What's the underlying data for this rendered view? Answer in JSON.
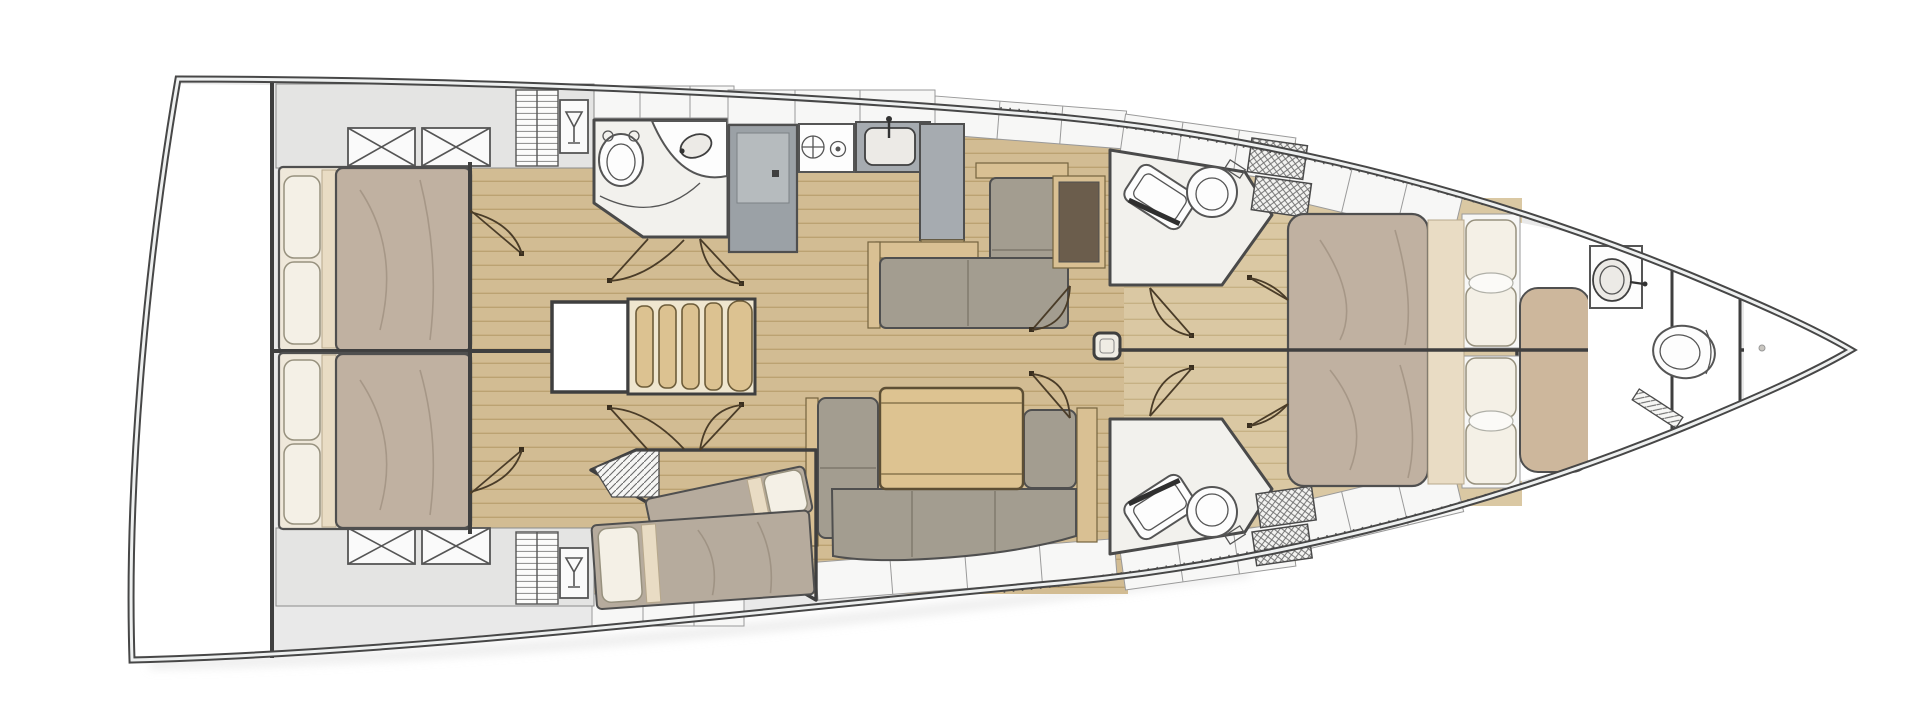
{
  "plan": {
    "label": "Sailing yacht interior layout floor plan, bow pointing right",
    "orientation": "bow-right",
    "visible_text": ""
  },
  "palette": {
    "wall": "#3f3f3f",
    "deck": "#e9e9e9",
    "hull-rail": "#474747",
    "hull-gap": "#eef0f0",
    "panel": "#f7f7f6",
    "head-floor": "#f2f1ed",
    "floor-wood": "#d2bc93",
    "floor-wood-line": "#bba272",
    "floor-fwd": "#dac8a3",
    "floor-fwd-line": "#c6b184",
    "cabinet-gray": "#9ba1a6",
    "cabinet-gray-light": "#b6bbbe",
    "counter-gray": "#a6abb0",
    "sofa": "#a39d90",
    "sofa-line": "#7e786c",
    "wood-trim": "#d9c093",
    "wood-trim-line": "#74643f",
    "table": "#ddc391",
    "bed-blanket": "#c0b1a1",
    "bed-blanket-gray": "#b6ab9d",
    "bed-sheet": "#e9dcc4",
    "pillow": "#f4f0e6",
    "pillow-line": "#97917e",
    "dark-top": "#6b5d4c",
    "stair": "#dcc291",
    "bench-tan": "#cdb79c",
    "door": "#4a3c28",
    "fixture-line": "#555555"
  },
  "rooms": [
    {
      "id": "stern-platform",
      "label": "Stern / transom platform",
      "fixtures": []
    },
    {
      "id": "aft-cabin-port",
      "label": "Aft cabin port (top)",
      "fixtures": [
        "double-bed",
        "pillows",
        "wardrobe-x-doors",
        "shelf-locker",
        "hanging-locker"
      ]
    },
    {
      "id": "aft-cabin-starboard",
      "label": "Aft cabin starboard (bottom)",
      "fixtures": [
        "double-bed",
        "pillows",
        "wardrobe-x-doors",
        "shelf-locker",
        "hanging-locker"
      ]
    },
    {
      "id": "companionway",
      "label": "Companionway stairs and landing",
      "fixtures": [
        "stairs",
        "landing-hatch"
      ]
    },
    {
      "id": "aft-head",
      "label": "Aft day head (top)",
      "fixtures": [
        "toilet",
        "sink-counter"
      ]
    },
    {
      "id": "galley",
      "label": "Galley (top centre)",
      "fixtures": [
        "fridge",
        "two-burner-stove",
        "sink",
        "counter"
      ]
    },
    {
      "id": "salon",
      "label": "Salon",
      "fixtures": [
        "l-shaped-sofa",
        "side-cabinet",
        "dining-table",
        "u-shaped-dinette-sofa"
      ]
    },
    {
      "id": "bunk-cabin",
      "label": "Midship cabin (bottom) with two single berths",
      "fixtures": [
        "single-berth",
        "single-berth",
        "louvered-locker"
      ]
    },
    {
      "id": "forward-head-port",
      "label": "Forward head port (top)",
      "fixtures": [
        "shower-bench",
        "toilet",
        "shower-grating"
      ]
    },
    {
      "id": "forward-head-starboard",
      "label": "Forward head starboard (bottom)",
      "fixtures": [
        "shower-bench",
        "toilet",
        "shower-grating"
      ]
    },
    {
      "id": "owner-cabin",
      "label": "Owner cabin forward with island double bed",
      "fixtures": [
        "island-double-bed",
        "pillows",
        "side-shelves",
        "bench-seat",
        "mast-post",
        "centerline-partition"
      ]
    },
    {
      "id": "bow-head",
      "label": "Bow en-suite head",
      "fixtures": [
        "corner-sink",
        "toilet",
        "louvered-door"
      ]
    },
    {
      "id": "anchor-locker",
      "label": "Bow anchor locker",
      "fixtures": []
    }
  ]
}
